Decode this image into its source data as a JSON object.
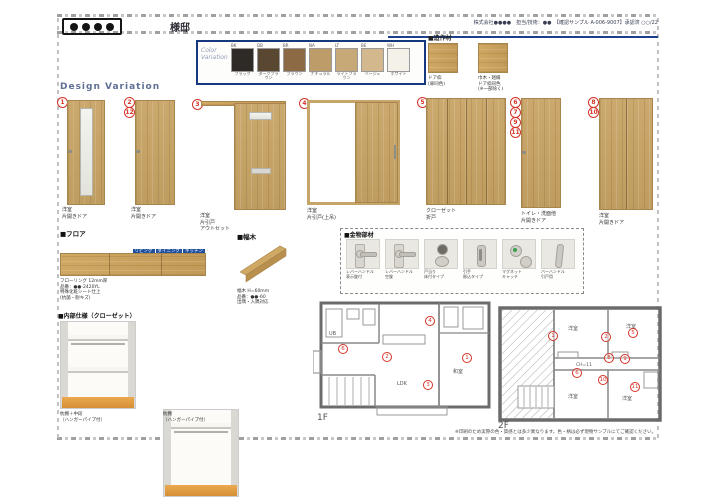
{
  "header": {
    "client_dots": "●●●●",
    "client_suffix": "様邸",
    "company_info": "株式会社●●●●　担当/技術：●●　【確認サンプル A-006-9007】承認済 ○○/22"
  },
  "color_variation": {
    "title_line1": "Color",
    "title_line2": "Variation",
    "swatches": [
      {
        "code": "BK",
        "name": "ブラック",
        "color": "#2e2b27"
      },
      {
        "code": "DB",
        "name": "ダークブラウン",
        "color": "#5a4732"
      },
      {
        "code": "BR",
        "name": "ブラウン",
        "color": "#8c6b44"
      },
      {
        "code": "NA",
        "name": "ナチュラル",
        "color": "#bd9c6a"
      },
      {
        "code": "LT",
        "name": "ライトブラウン",
        "color": "#c6a977"
      },
      {
        "code": "BE",
        "name": "ベージュ",
        "color": "#d2b88c"
      },
      {
        "code": "WH",
        "name": "ホワイト",
        "color": "#f4f1e9"
      }
    ]
  },
  "zosaku": {
    "title": "■造作材",
    "item1": {
      "l1": "ドア枠",
      "l2": "(扉同色)"
    },
    "item2": {
      "l1": "巾木・廻縁",
      "l2": "ドア枠同色",
      "l3": "(※一部除く)"
    }
  },
  "design_variation": {
    "title": "Design Variation",
    "doors": [
      {
        "n1": "1",
        "labels": {
          "l1": "洋室",
          "l2": "片開きドア"
        }
      },
      {
        "n1": "2",
        "n2": "12",
        "labels": {
          "l1": "洋室",
          "l2": "片開きドア"
        }
      },
      {
        "n1": "3",
        "labels": {
          "l1": "洋室",
          "l2": "片引戸",
          "l3": "アウトセット"
        }
      },
      {
        "n1": "4",
        "labels": {
          "l1": "洋室",
          "l2": "片引戸(上吊)"
        }
      },
      {
        "n1": "5",
        "labels": {
          "l1": "クローゼット",
          "l2": "折戸"
        }
      },
      {
        "n1": "6",
        "n2": "7",
        "n3": "9",
        "n4": "11",
        "labels": {
          "l1": "トイレ・洗面他",
          "l2": "片開きドア"
        }
      },
      {
        "n1": "8",
        "n2": "10",
        "labels": {
          "l1": "洋室",
          "l2": "片開きドア"
        }
      }
    ]
  },
  "floor": {
    "title": "■フロア",
    "row1": [
      "リビング",
      "ダイニング",
      "キッチン"
    ],
    "row2": [
      "廊下",
      "ホール",
      "洋室(1)",
      "洋室(2)",
      "洋室(3)",
      "WIC"
    ],
    "notes": [
      "フローリング 12mm厚",
      "品番：●●-2420YL",
      "特殊化粧シート仕上",
      "(抗菌・耐キズ)"
    ]
  },
  "habaki": {
    "title": "■幅木",
    "notes": [
      "幅木 H=60mm",
      "品番：●●-60",
      "出隅・入隅対応"
    ]
  },
  "kanamono": {
    "title": "■金物部材",
    "items": [
      {
        "l1": "レバーハンドル",
        "l2": "表示錠付"
      },
      {
        "l1": "レバーハンドル",
        "l2": "空錠"
      },
      {
        "l1": "戸当り",
        "l2": "床付タイプ"
      },
      {
        "l1": "引手",
        "l2": "彫込タイプ"
      },
      {
        "l1": "マグネット",
        "l2": "キャッチ"
      },
      {
        "l1": "バーハンドル",
        "l2": "引戸用"
      }
    ]
  },
  "naibu": {
    "title": "■内部仕様（クローゼット）",
    "item1": {
      "l1": "枕棚＋中段",
      "l2": "（ハンガーパイプ付）"
    },
    "item2": {
      "l1": "枕棚",
      "l2": "（ハンガーパイプ付）"
    }
  },
  "plans": {
    "f1_label": "1F",
    "f2_label": "2F",
    "ch_label": "CH=11",
    "rooms_1f": [
      "UB",
      "LDK",
      "和室"
    ],
    "rooms_2f": [
      "洋室",
      "洋室",
      "洋室",
      "洋室"
    ],
    "markers_1f": [
      "4",
      "6",
      "2",
      "1",
      "3"
    ],
    "markers_2f": [
      "1",
      "2",
      "5",
      "8",
      "9",
      "6",
      "10",
      "11"
    ]
  },
  "footer": {
    "note": "※印刷のため実際の色・質感とは多少異なります。色・柄は必ず現物サンプルにてご確認ください。"
  }
}
